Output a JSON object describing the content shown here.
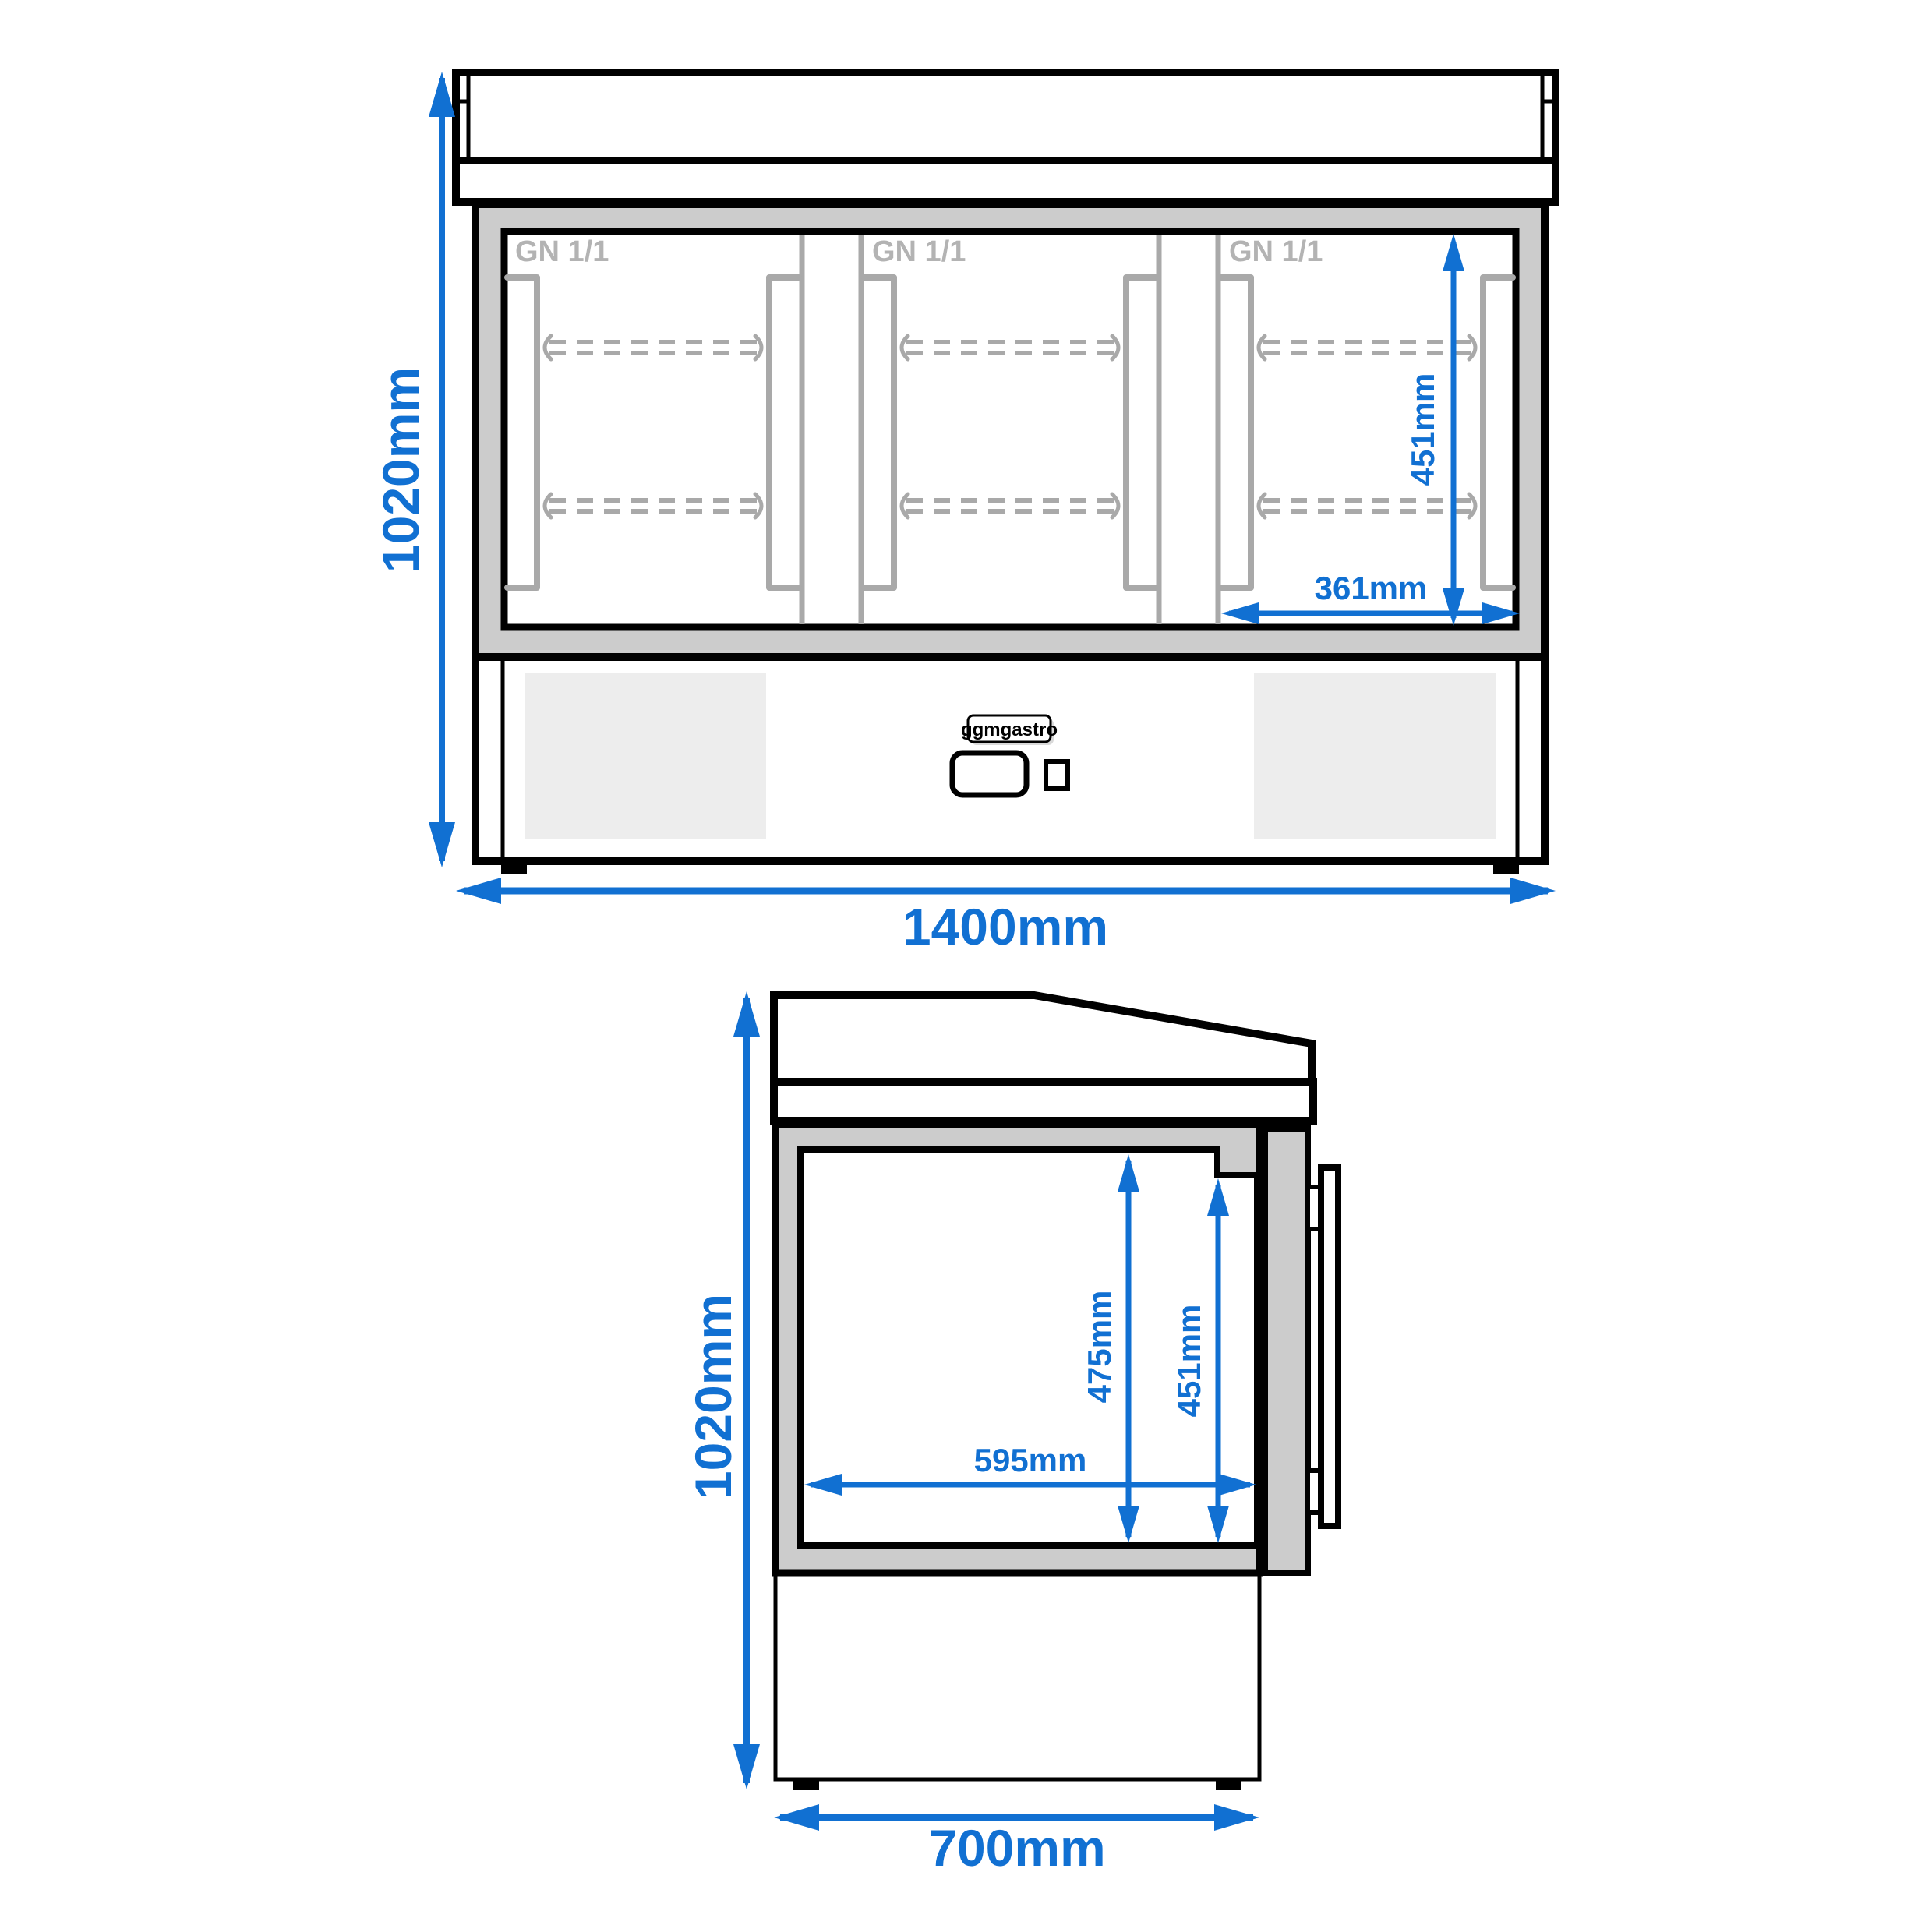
{
  "colors": {
    "dimension_blue": "#1170d2",
    "frame_gray": "#cccccc",
    "detail_gray": "#a9a9a9",
    "label_gray": "#b3b3b3",
    "vent_gray": "#ededed",
    "line_black": "#000000",
    "background": "#ffffff"
  },
  "brand": {
    "logo_text": "ggmgastro"
  },
  "front_view": {
    "dims": {
      "overall_height": "1020mm",
      "overall_width": "1400mm",
      "inner_height": "451mm",
      "inner_width": "361mm"
    },
    "doors": [
      {
        "label": "GN 1/1"
      },
      {
        "label": "GN 1/1"
      },
      {
        "label": "GN 1/1"
      }
    ]
  },
  "side_view": {
    "dims": {
      "overall_height": "1020mm",
      "overall_depth": "700mm",
      "cavity_height": "475mm",
      "door_opening_height": "451mm",
      "cavity_depth": "595mm"
    }
  }
}
